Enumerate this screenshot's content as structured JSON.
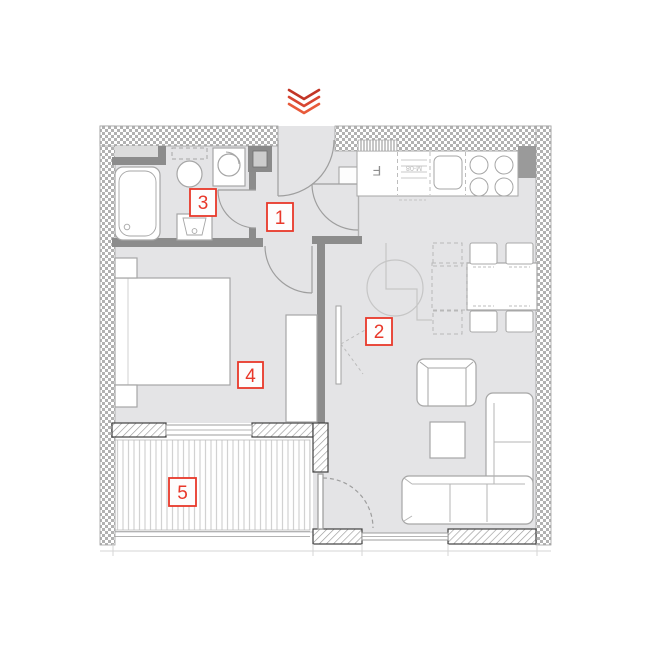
{
  "rooms": [
    {
      "number": "1"
    },
    {
      "number": "2"
    },
    {
      "number": "3"
    },
    {
      "number": "4"
    },
    {
      "number": "5"
    }
  ],
  "kitchen": {
    "fridge_label": "F",
    "counter_text": "M-08"
  },
  "colors": {
    "label_red": "#e8382a",
    "chevron_red_dark": "#c23526",
    "chevron_red_mid": "#d84531",
    "chevron_red_light": "#e85a3a",
    "wall_gray": "#8c8c8c",
    "floor_gray": "#e4e4e6",
    "furniture_stroke": "#a6a6a6"
  }
}
